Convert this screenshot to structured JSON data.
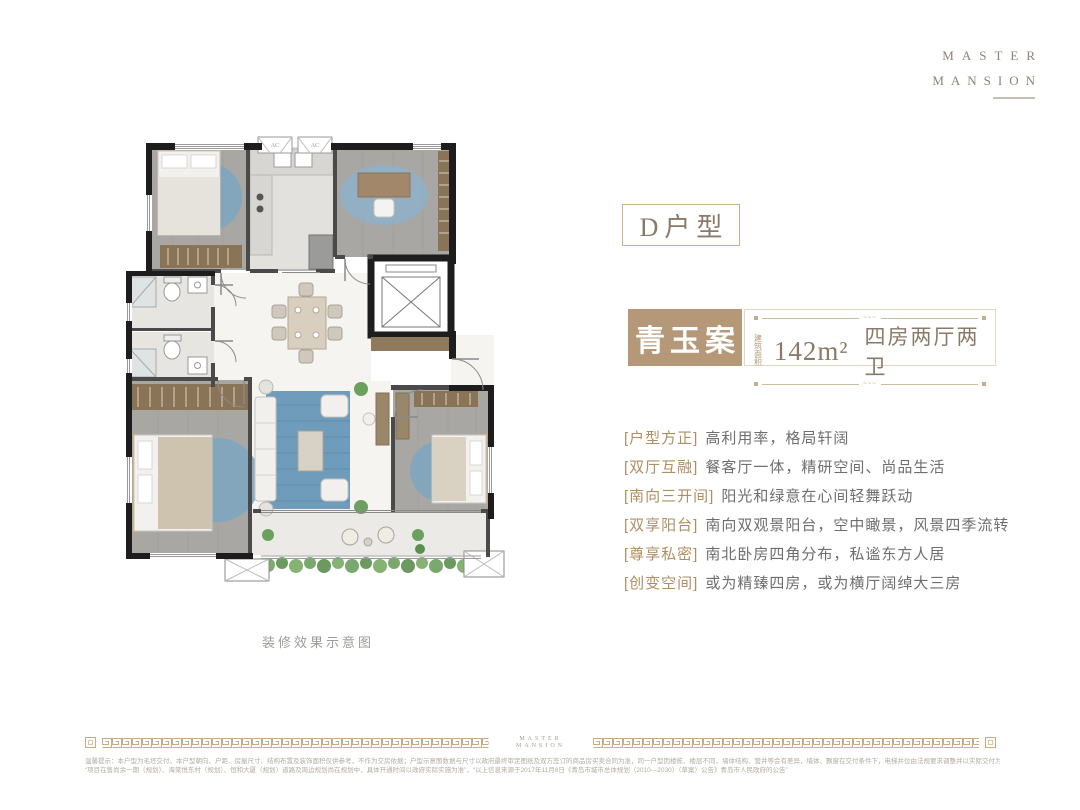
{
  "logo": {
    "line1": "MASTER",
    "line2": "MANSION"
  },
  "unit_title": "D户型",
  "spec": {
    "name": "青玉案",
    "area_label_top": "建筑",
    "area_label_bottom": "面积",
    "area_value": "142m²",
    "rooms": "四房两厅两卫"
  },
  "features": [
    {
      "tag": "[户型方正]",
      "desc": "高利用率，格局轩阔"
    },
    {
      "tag": "[双厅互融]",
      "desc": "餐客厅一体，精研空间、尚品生活"
    },
    {
      "tag": "[南向三开间]",
      "desc": "阳光和绿意在心间轻舞跃动"
    },
    {
      "tag": "[双享阳台]",
      "desc": "南向双观景阳台，空中瞰景，风景四季流转"
    },
    {
      "tag": "[尊享私密]",
      "desc": "南北卧房四角分布，私谧东方人居"
    },
    {
      "tag": "[创变空间]",
      "desc": "或为精臻四房，或为横厅阔绰大三房"
    }
  ],
  "floorplan": {
    "caption": "装修效果示意图",
    "ac_label": "AC"
  },
  "footer": {
    "brand_line1": "MASTER",
    "brand_line2": "MANSION",
    "disclaimer_line1": "温馨提示：本户型为毛坯交付，本户型朝向、户距、房屋尺寸、结构布置及装饰面积仅供参考，不作为交房依据；户型示意图数据与尺寸以政府最终审定图纸及双方签订的商品房买卖合同为准，同一户型因楼栋、楼层不同，墙体结构、管井等会有差异，墙体、飘窗在交付条件下，电梯井位由法规要求调整并以实际交付为准，以上图文仅供参考，一切图文资料、设计均以政府最终批准文件及双方签订的买卖合同为准，本图文资料仅为要约邀请，一切以双方最终签署的买卖合同及政府法律文件为准。本项目推广名为：",
    "disclaimer_line2": "“项目在售尚余一期（规划）、海棠悦东村（规划）、恒和大厦（规划）道路及周边规划尚在规划中，具体开通时间以政府实际实施为准”，“以上信息来源于2017年11月8日《青岛市城市总体规划（2010—2030）（草案）公告》青岛市人民政府的公告”"
  },
  "colors": {
    "accent_tan": "#b49878",
    "tag_gold": "#b08e63",
    "text_gray": "#6e6e6e",
    "wall_black": "#1d1d1d",
    "rug_blue": "#7ea6c0"
  }
}
